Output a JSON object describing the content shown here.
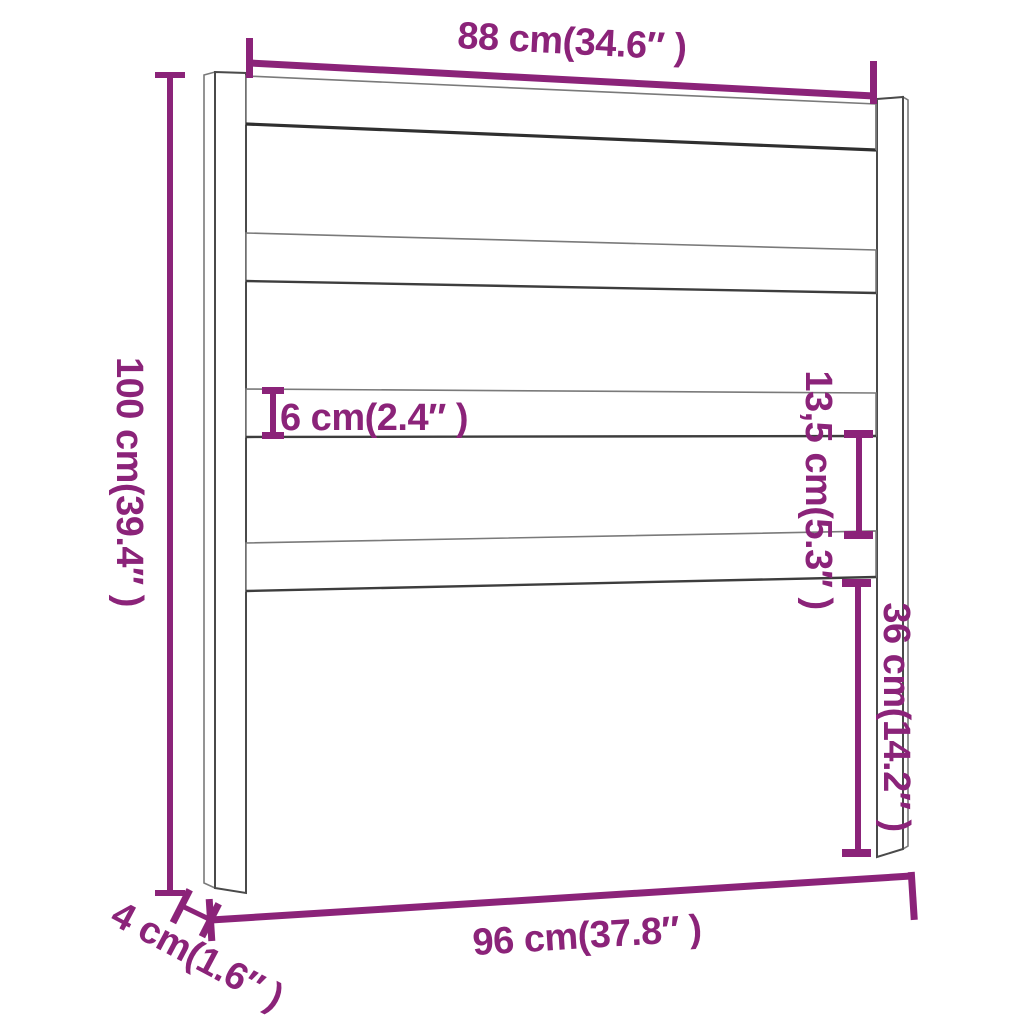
{
  "diagram": {
    "accent_color": "#8B2379",
    "outline_color": "#4A4A4A",
    "dimensions": {
      "top_width": {
        "label": "88 cm(34.6″ )",
        "value_cm": 88,
        "value_in": 34.6
      },
      "height": {
        "label": "100 cm(39.4″ )",
        "value_cm": 100,
        "value_in": 39.4
      },
      "slat_height": {
        "label": "6 cm(2.4″ )",
        "value_cm": 6,
        "value_in": 2.4
      },
      "slat_gap": {
        "label": "13,5 cm(5.3″ )",
        "value_cm": 13.5,
        "value_in": 5.3
      },
      "lower_height": {
        "label": "36 cm(14.2″ )",
        "value_cm": 36,
        "value_in": 14.2
      },
      "total_width": {
        "label": "96 cm(37.8″ )",
        "value_cm": 96,
        "value_in": 37.8
      },
      "post_depth": {
        "label": "4 cm(1.6″ )",
        "value_cm": 4,
        "value_in": 1.6
      }
    }
  }
}
